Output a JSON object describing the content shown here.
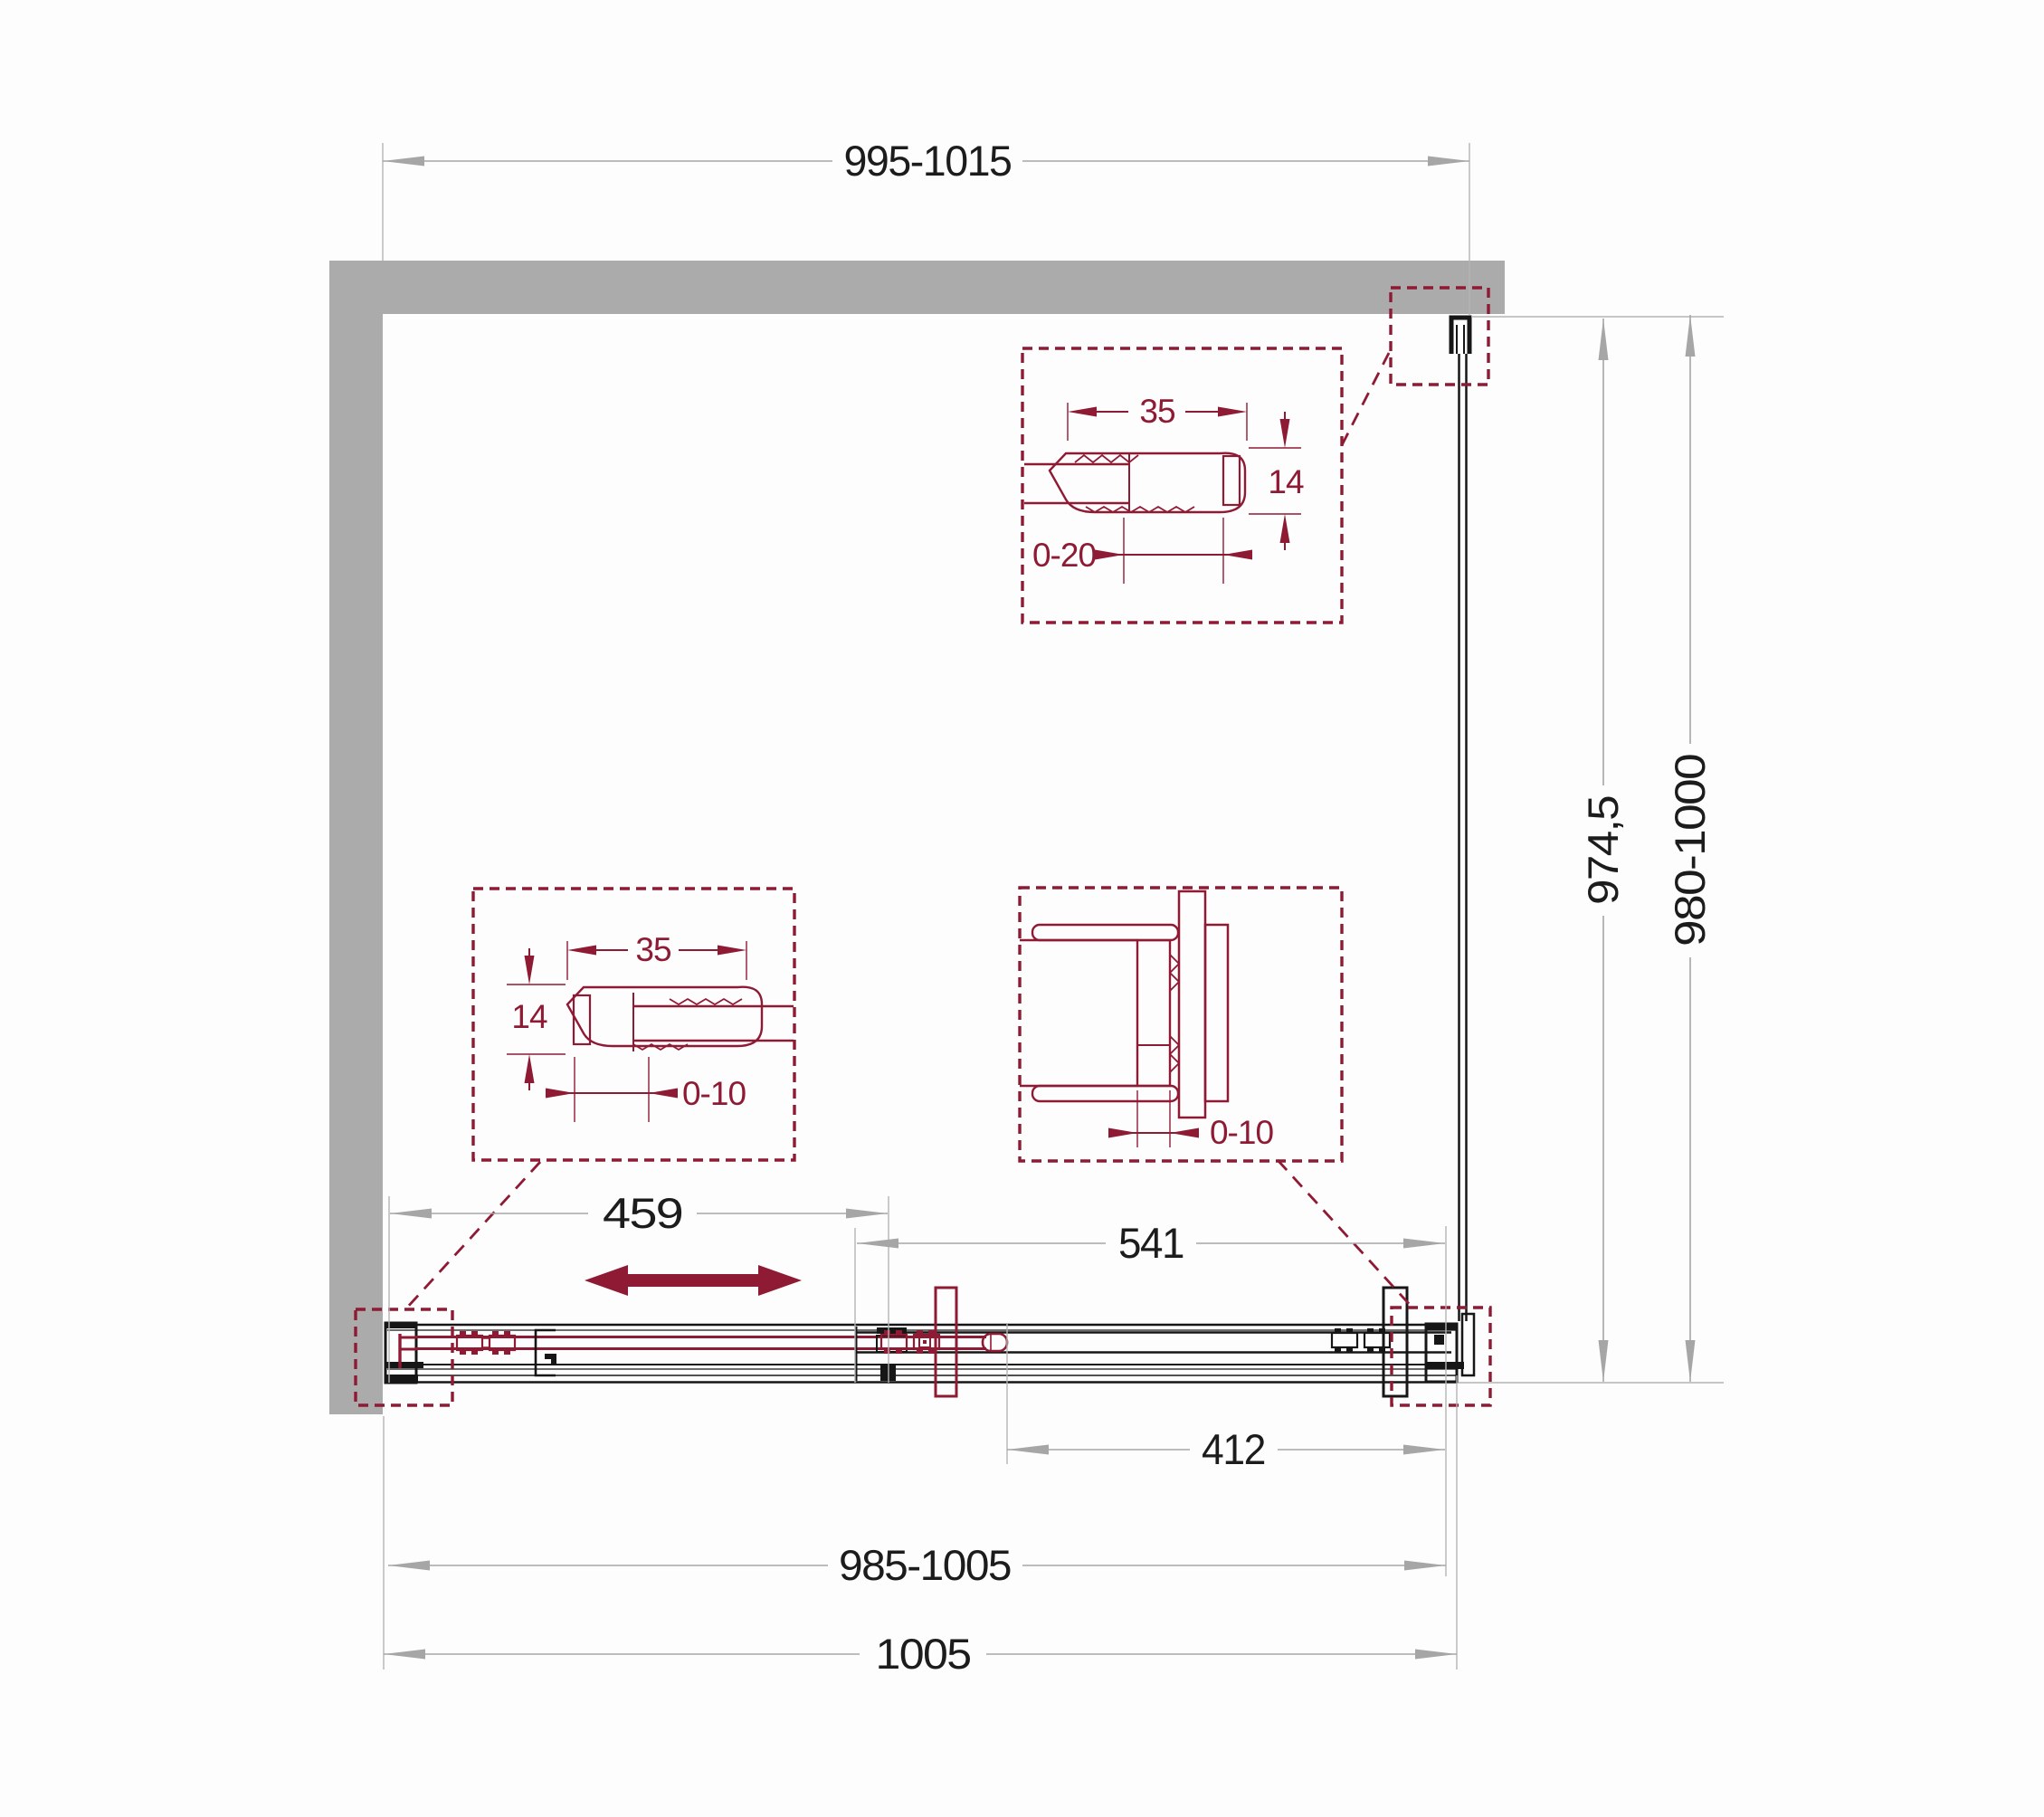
{
  "drawing_title": "shower-enclosure-plan-technical-drawing",
  "colors": {
    "wall": "#ababab",
    "outline": "#161616",
    "accent": "#8e1a34",
    "dimension_line": "#a6a6a6",
    "dimension_text": "#1c1c1c"
  },
  "dims": {
    "top_width": "995-1015",
    "height_inner": "974,5",
    "height_outer": "980-1000",
    "door_zone_width": "459",
    "fixed_zone_width": "541",
    "panel_width": "412",
    "width_range": "985-1005",
    "width_total": "1005"
  },
  "detail_wall_profile_top": {
    "width": "35",
    "height": "14",
    "range": "0-20"
  },
  "detail_wall_profile_left": {
    "width": "35",
    "height": "14",
    "range": "0-10"
  },
  "detail_panel_connector": {
    "range": "0-10"
  }
}
